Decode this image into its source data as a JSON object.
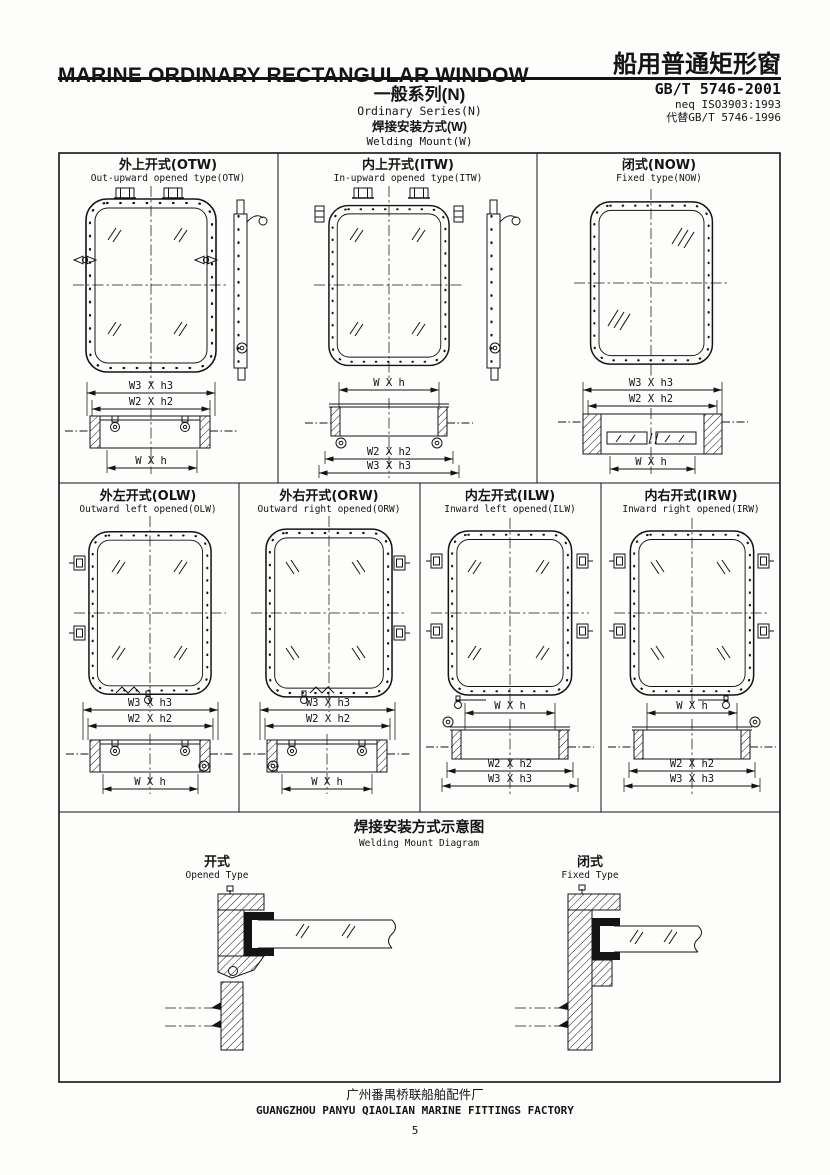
{
  "header": {
    "title_en": "MARINE ORDINARY RECTANGULAR WINDOW",
    "title_zh": "船用普通矩形窗",
    "series_zh": "一般系列(N)",
    "series_en": "Ordinary Series(N)",
    "standard_code": "GB/T 5746-2001",
    "standard_neq": "neq ISO3903:1993",
    "standard_replaces": "代替GB/T 5746-1996",
    "mount_zh": "焊接安装方式(W)",
    "mount_en": "Welding Mount(W)"
  },
  "panels": {
    "otw": {
      "title_zh": "外上开式(OTW)",
      "title_en": "Out-upward opened type(OTW)",
      "dim1": "W3 X h3",
      "dim2": "W2 X h2",
      "dim3": "W X h"
    },
    "itw": {
      "title_zh": "内上开式(ITW)",
      "title_en": "In-upward opened type(ITW)",
      "dim1": "W X h",
      "dim2": "W2 X h2",
      "dim3": "W3 X h3"
    },
    "now": {
      "title_zh": "闭式(NOW)",
      "title_en": "Fixed type(NOW)",
      "dim1": "W3 X h3",
      "dim2": "W2 X h2",
      "dim3": "W X h"
    },
    "olw": {
      "title_zh": "外左开式(OLW)",
      "title_en": "Outward left opened(OLW)",
      "dim1": "W3 X h3",
      "dim2": "W2 X h2",
      "dim3": "W X h"
    },
    "orw": {
      "title_zh": "外右开式(ORW)",
      "title_en": "Outward right opened(ORW)",
      "dim1": "W3 X h3",
      "dim2": "W2 X h2",
      "dim3": "W X h"
    },
    "ilw": {
      "title_zh": "内左开式(ILW)",
      "title_en": "Inward left opened(ILW)",
      "dim1": "W X h",
      "dim2": "W2 X h2",
      "dim3": "W3 X h3"
    },
    "irw": {
      "title_zh": "内右开式(IRW)",
      "title_en": "Inward right opened(IRW)",
      "dim1": "W X h",
      "dim2": "W2 X h2",
      "dim3": "W3 X h3"
    }
  },
  "welding_diagram": {
    "title_zh": "焊接安装方式示意图",
    "title_en": "Welding Mount Diagram",
    "opened_zh": "开式",
    "opened_en": "Opened Type",
    "fixed_zh": "闭式",
    "fixed_en": "Fixed Type"
  },
  "footer": {
    "factory_zh": "广州番禺桥联船舶配件厂",
    "factory_en": "GUANGZHOU PANYU QIAOLIAN MARINE FITTINGS FACTORY",
    "page_number": "5"
  }
}
